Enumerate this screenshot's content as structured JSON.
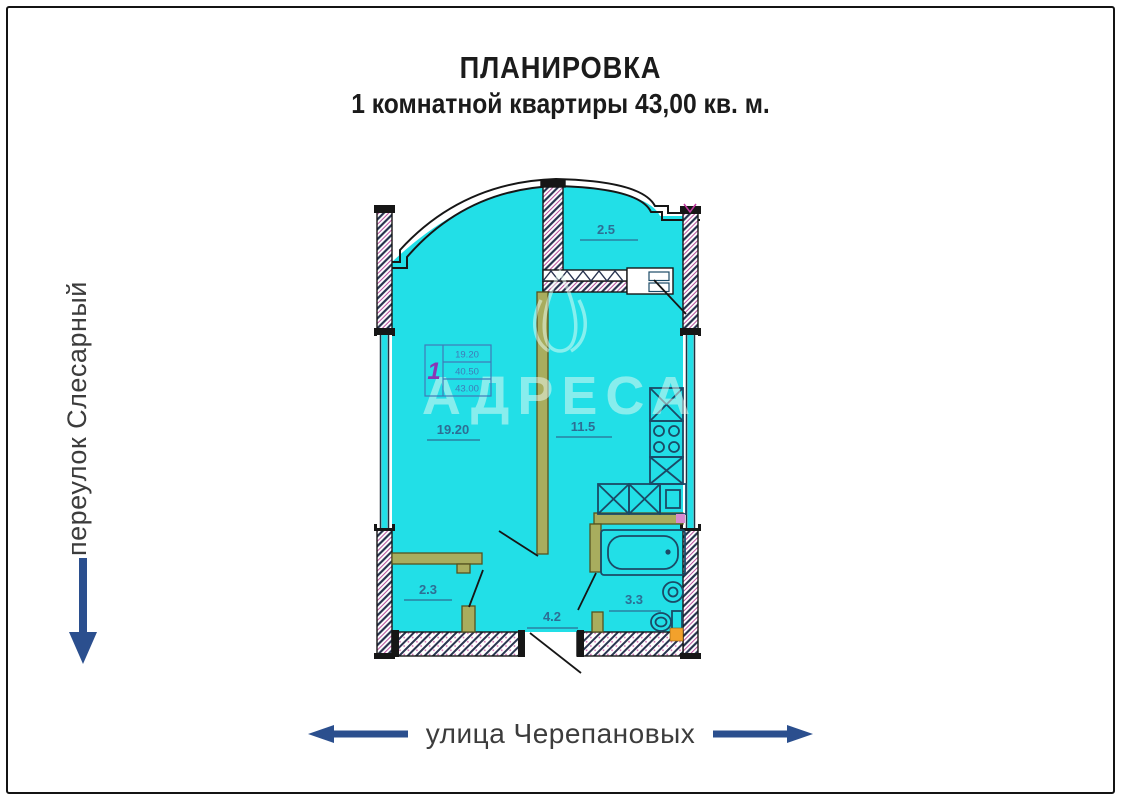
{
  "title": {
    "line1": "ПЛАНИРОВКА",
    "line2": "1 комнатной квартиры 43,00 кв. м."
  },
  "streets": {
    "left_street": "переулок Слесарный",
    "bottom_street": "улица Черепановых"
  },
  "watermark": {
    "brand": "АДРЕСА",
    "logo": "tulip-icon"
  },
  "stamp": {
    "room_count": "1",
    "living_area": "19.20",
    "area_without_balcony": "40.50",
    "total_area": "43.00"
  },
  "plan": {
    "areas": {
      "balcony": "2.5",
      "living": "19.20",
      "kitchen": "11.5",
      "closet": "2.3",
      "hall": "4.2",
      "bath": "3.3"
    }
  },
  "colors": {
    "floor_fill": "#22dfe7",
    "partition_wall": "#a8ad5e",
    "area_label": "#2d6e94",
    "arrow_blue": "#2b4f8e",
    "stamp_blue": "#3f7ab8",
    "stamp_number_violet": "#8a35b5",
    "fixture_navy": "#1b4a66",
    "accent_orange": "#f2a12c",
    "title_black": "#1b1b1b"
  }
}
